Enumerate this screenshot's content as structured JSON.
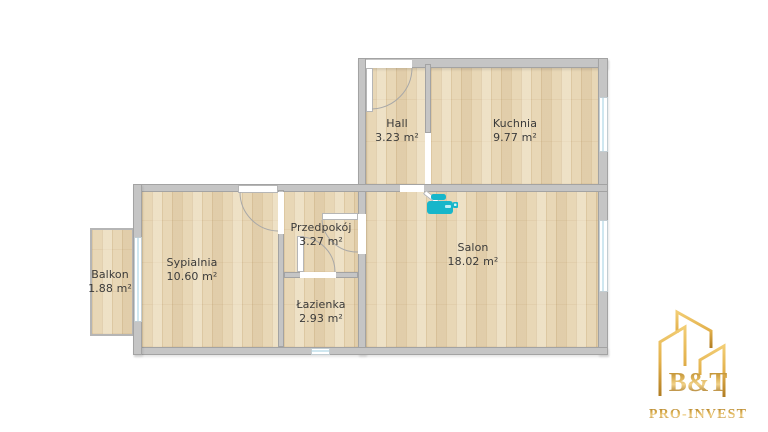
{
  "floorplan": {
    "rooms": [
      {
        "id": "balkon",
        "name": "Balkon",
        "area": "1.88 m²"
      },
      {
        "id": "sypialnia",
        "name": "Sypialnia",
        "area": "10.60 m²"
      },
      {
        "id": "przedpokoj",
        "name": "Przedpokój",
        "area": "3.27 m²"
      },
      {
        "id": "lazienka",
        "name": "Łazienka",
        "area": "2.93 m²"
      },
      {
        "id": "hall",
        "name": "Hall",
        "area": "3.23 m²"
      },
      {
        "id": "kuchnia",
        "name": "Kuchnia",
        "area": "9.77 m²"
      },
      {
        "id": "salon",
        "name": "Salon",
        "area": "18.02 m²"
      }
    ],
    "markers": [
      {
        "type": "3d-camera-marker",
        "room": "salon",
        "color": "#17b6ca"
      }
    ],
    "colors": {
      "wall": "#c5c5c5",
      "wall_outline": "#a3a3a3",
      "floor_wood": "#e8d7b6",
      "window_glass": "#cfe7f0",
      "label_text": "#3b3b3b"
    }
  },
  "logo": {
    "title": "B&T",
    "subtitle": "PRO-INVEST",
    "color_gold": "#c9953a"
  }
}
